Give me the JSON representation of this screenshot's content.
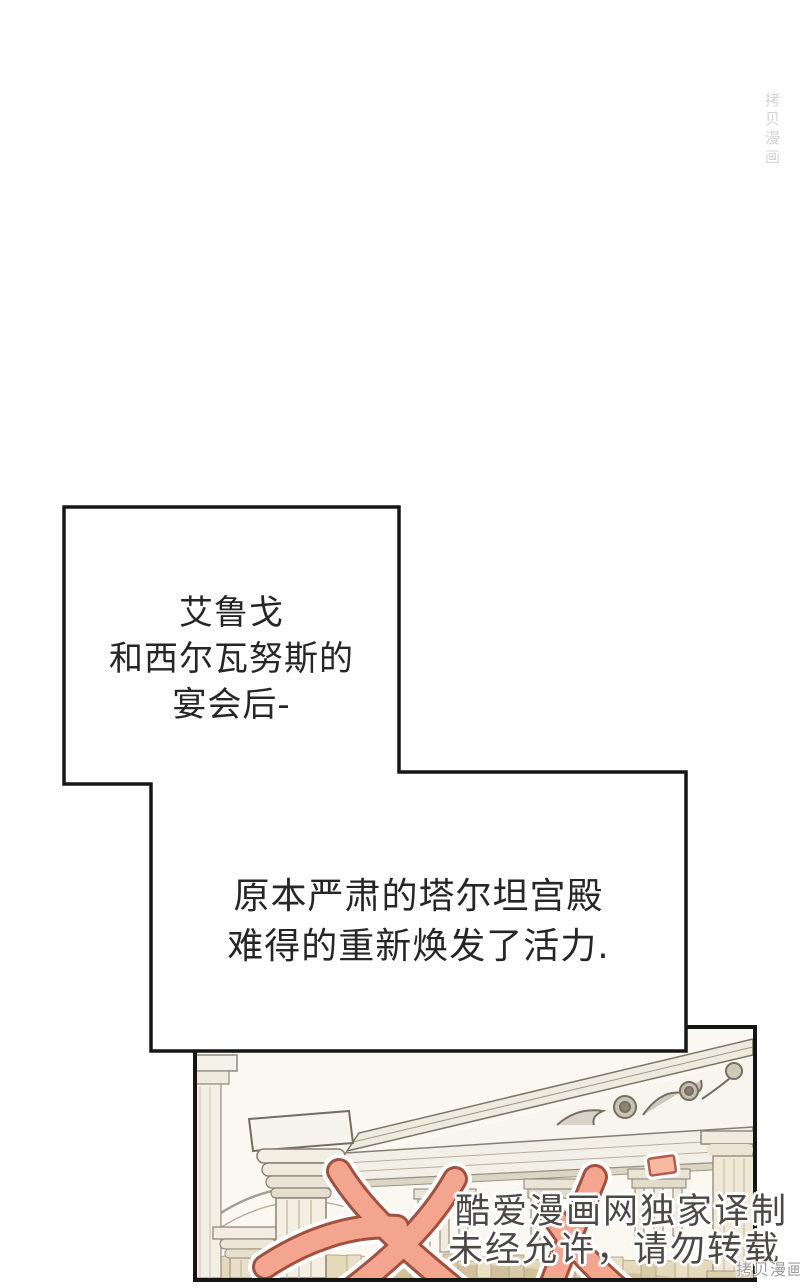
{
  "page": {
    "background": "#ffffff"
  },
  "narration": {
    "box1": {
      "line1": "艾鲁戈",
      "line2": "和西尔瓦努斯的",
      "line3": "宴会后-"
    },
    "box2": {
      "line1": "原本严肃的塔尔坦宫殿",
      "line2": "难得的重新焕发了活力."
    }
  },
  "watermark": {
    "translator_line1": "酷爱漫画网独家译制",
    "translator_line2": "未经允许，请勿转载",
    "site_badge_bottom": "拷贝漫画",
    "site_badge_top": "拷贝漫画",
    "text_color": "#4B4946",
    "brush_color": "#F4A58F"
  },
  "panel": {
    "scene": "greek-palace-colonnade"
  }
}
